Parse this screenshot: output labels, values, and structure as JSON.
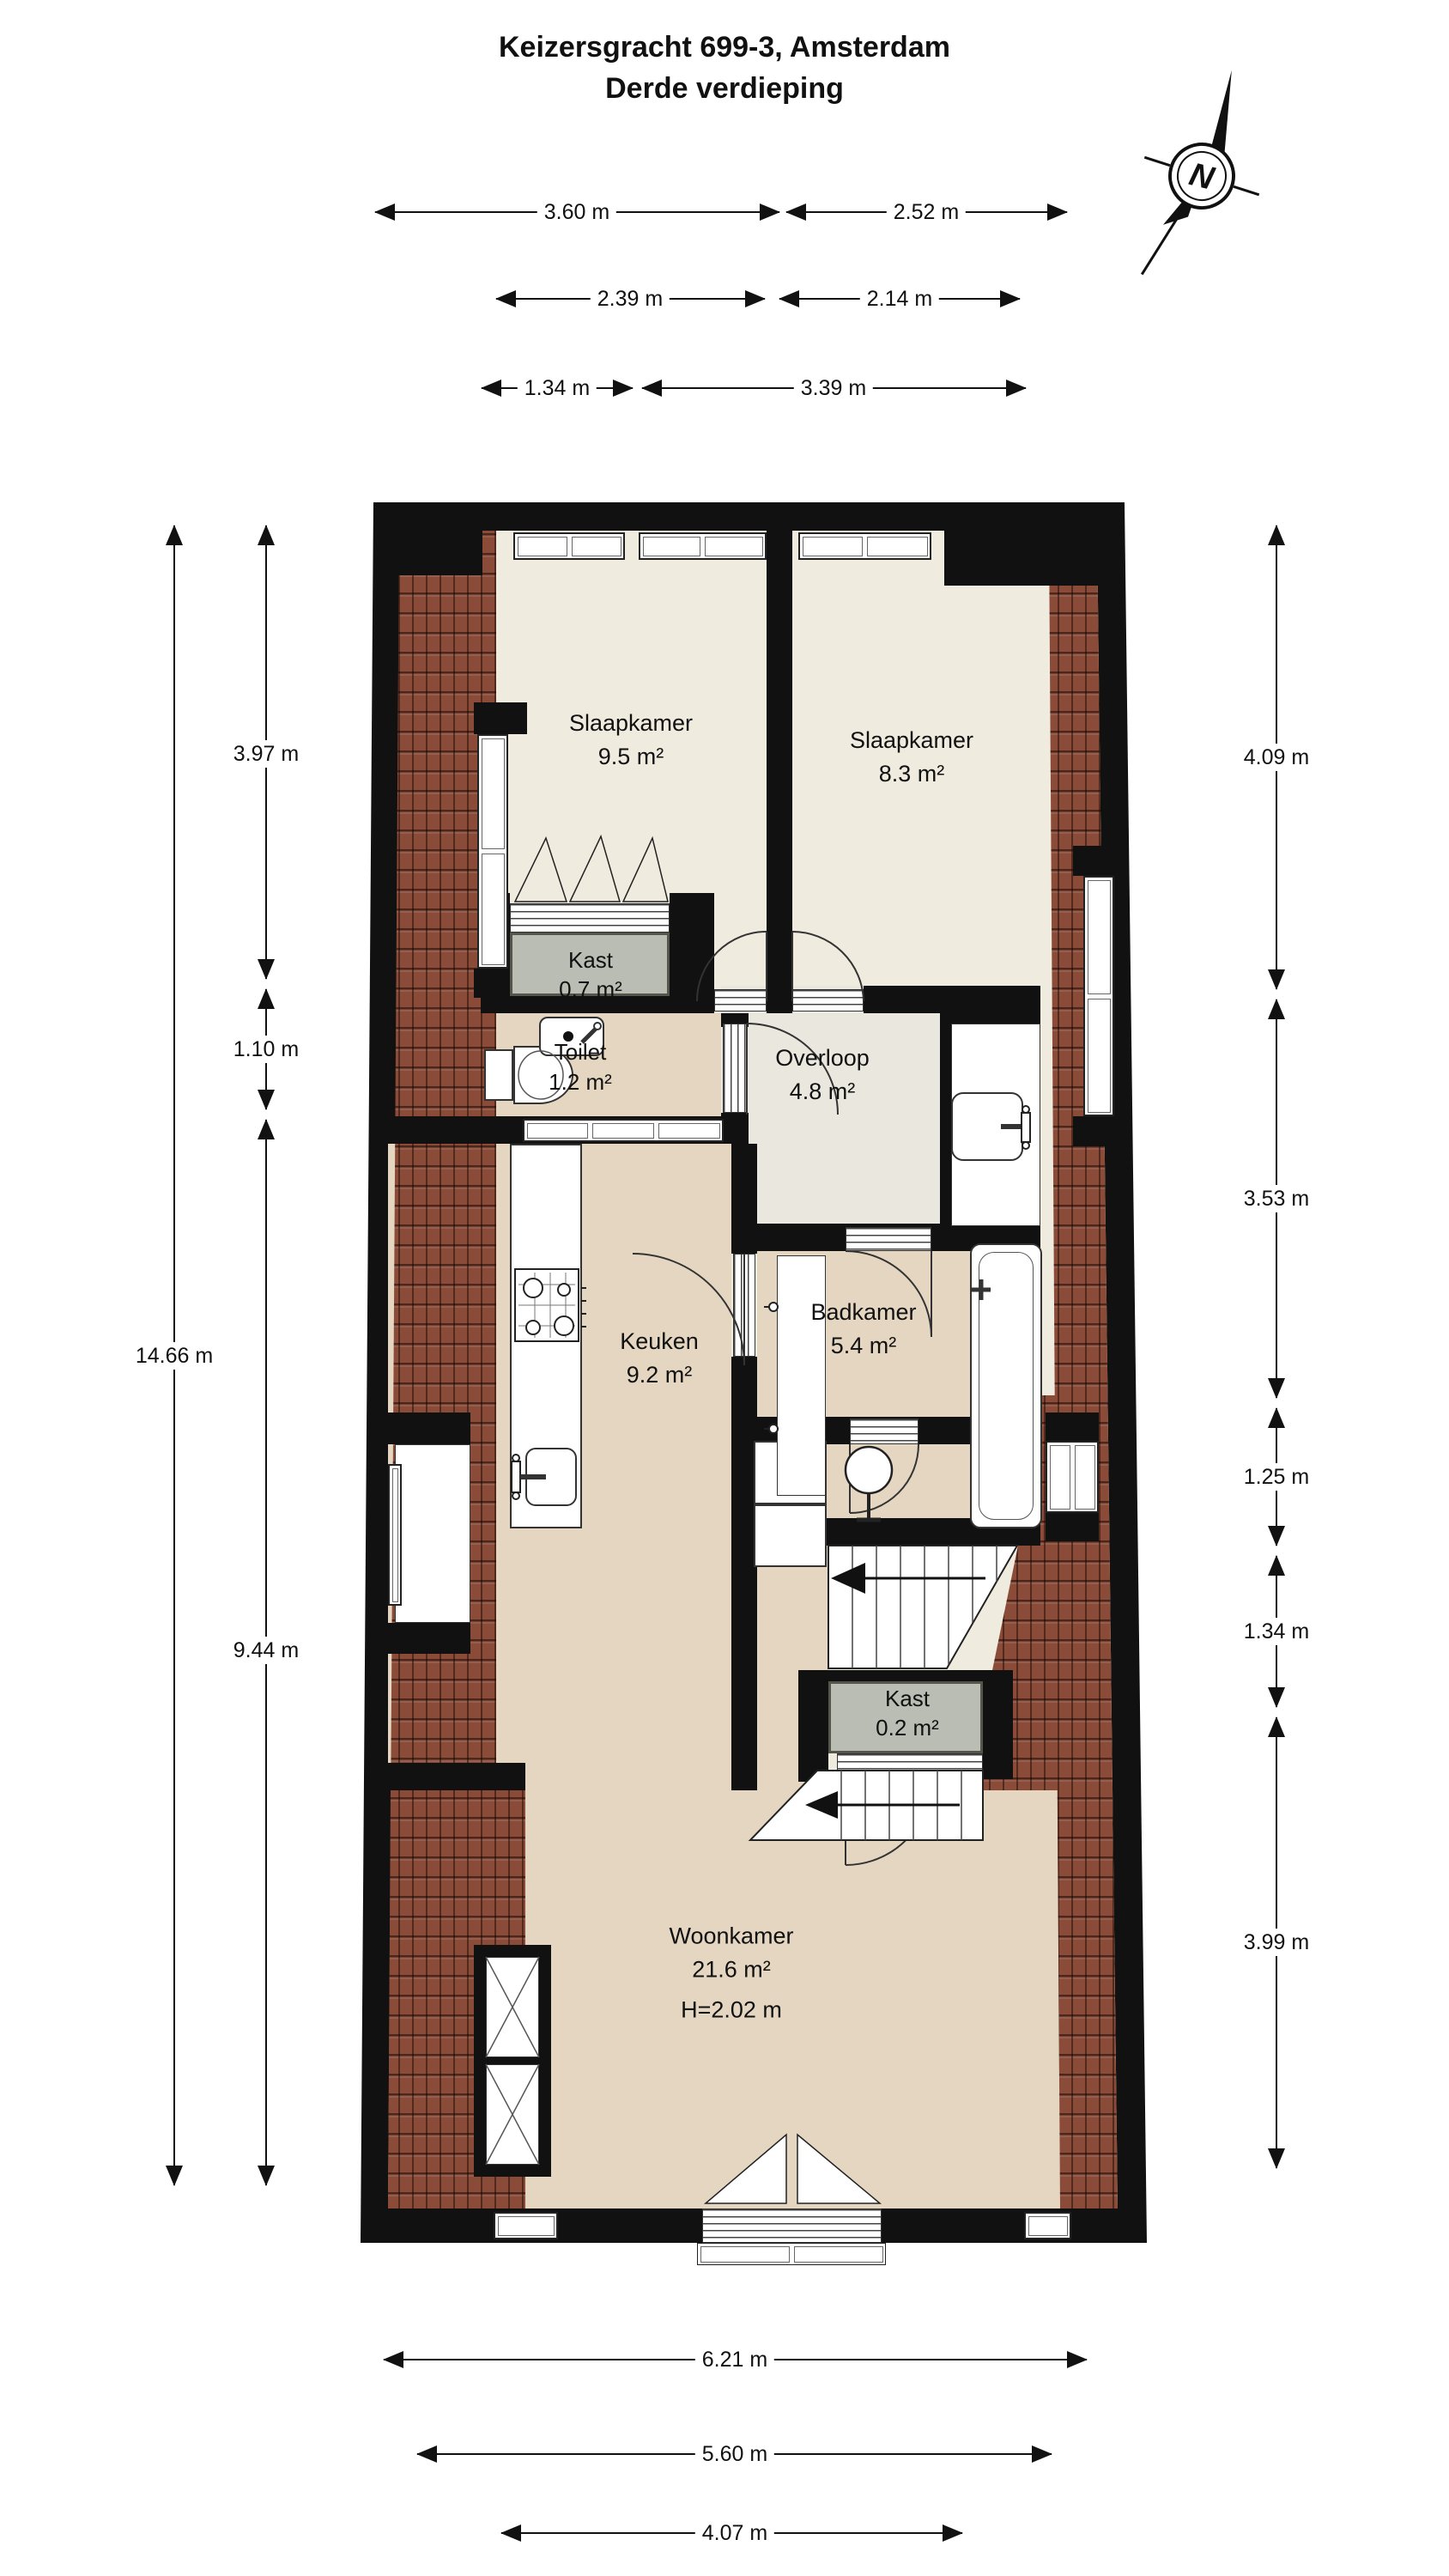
{
  "title": {
    "line1": "Keizersgracht 699-3, Amsterdam",
    "line2": "Derde verdieping"
  },
  "compass": {
    "label": "N"
  },
  "rooms": [
    {
      "id": "slaapkamer-1",
      "name": "Slaapkamer",
      "area": "9.5 m²"
    },
    {
      "id": "slaapkamer-2",
      "name": "Slaapkamer",
      "area": "8.3 m²"
    },
    {
      "id": "kast-1",
      "name": "Kast",
      "area": "0.7 m²"
    },
    {
      "id": "toilet",
      "name": "Toilet",
      "area": "1.2 m²"
    },
    {
      "id": "overloop",
      "name": "Overloop",
      "area": "4.8 m²"
    },
    {
      "id": "badkamer",
      "name": "Badkamer",
      "area": "5.4 m²"
    },
    {
      "id": "keuken",
      "name": "Keuken",
      "area": "9.2 m²"
    },
    {
      "id": "kast-2",
      "name": "Kast",
      "area": "0.2 m²"
    },
    {
      "id": "woonkamer",
      "name": "Woonkamer",
      "area": "21.6 m²",
      "height": "H=2.02 m"
    }
  ],
  "dimensions": {
    "top": [
      [
        "3.60 m",
        "2.52 m"
      ],
      [
        "2.39 m",
        "2.14 m"
      ],
      [
        "1.34 m",
        "3.39 m"
      ]
    ],
    "left_inner": [
      "3.97 m",
      "1.10 m",
      "9.44 m"
    ],
    "left_outer": [
      "14.66 m"
    ],
    "right": [
      "4.09 m",
      "3.53 m",
      "1.25 m",
      "1.34 m",
      "3.99 m"
    ],
    "bottom": [
      "6.21 m",
      "5.60 m",
      "4.07 m"
    ]
  },
  "colors": {
    "wall": "#111111",
    "roof_tiles": "#8a4c38",
    "floor_cream": "#f0ebdf",
    "floor_beige": "#e4d6c1",
    "floor_overloop": "#eae7de",
    "closet_gray": "#b9bdb3"
  }
}
